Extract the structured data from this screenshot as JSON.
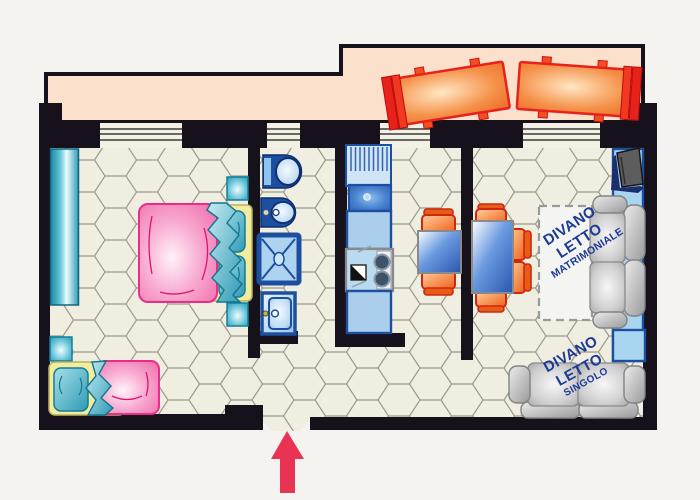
{
  "page": {
    "background_color": "#f5f3ef"
  },
  "plan": {
    "type": "apartment-floor-plan",
    "colors": {
      "wall": "#17111b",
      "terrace": "#fbe0cb",
      "floor": "#efeee1",
      "floor_grid": "#9b9a8c",
      "fixture_outline_blue": "#1d4fa0",
      "fixture_fill_blue": "#aed3f0",
      "furniture_teal": "#2d9cb4",
      "bed_pink": "#ee62a5",
      "bed_frame_yellow": "#f1ec9e",
      "chair_orange": "#ee6a20",
      "lounger_red": "#e8211d",
      "sofa_gray": "#b5b5b5",
      "table_blue": "#2a55ad",
      "label_blue": "#1d3a94",
      "arrow_red": "#e83354"
    }
  },
  "labels": {
    "divano_matrimoniale": [
      "DIVANO",
      "LETTO",
      "MATRIMONIALE"
    ],
    "divano_singolo": [
      "DIVANO",
      "LETTO",
      "SINGOLO"
    ]
  },
  "furniture": [
    "wardrobe",
    "double-bed",
    "bed-pillow",
    "nightstand",
    "single-bed",
    "toilet",
    "bidet",
    "shower",
    "washing-machine",
    "dish-drainer",
    "kitchen-sink",
    "kitchen-counter",
    "cooktop",
    "kitchen-table",
    "dining-table",
    "chair",
    "tv",
    "tv-shelf",
    "sofa-bed-double",
    "sofa-bed-single",
    "side-table",
    "sun-lounger",
    "entrance-arrow"
  ]
}
